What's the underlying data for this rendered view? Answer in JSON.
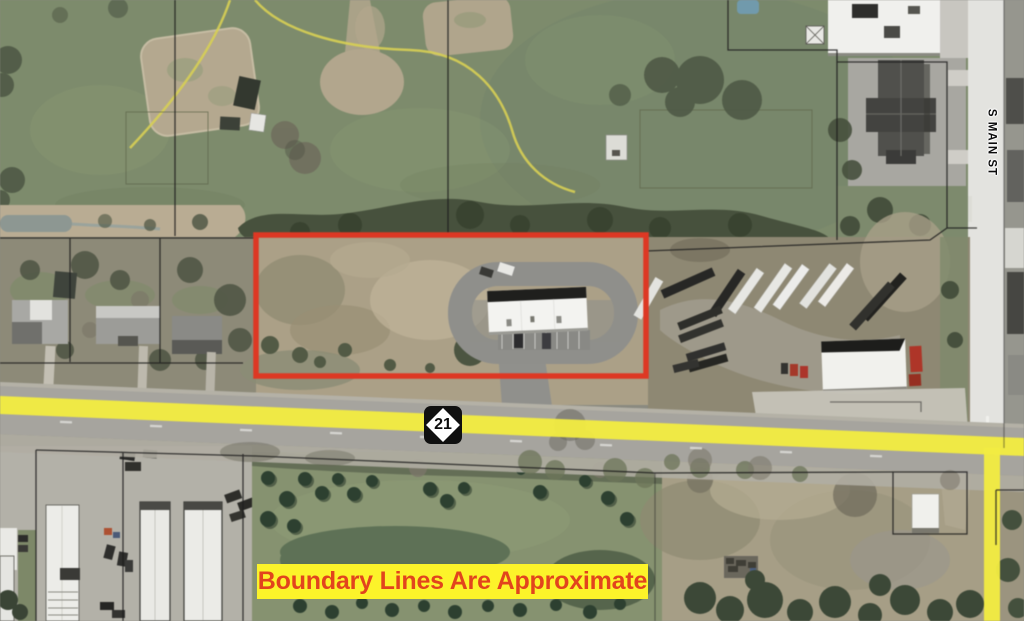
{
  "map": {
    "type": "aerial-parcel-map",
    "street_label": "S MAIN ST",
    "route_shield_number": "21",
    "disclaimer_banner": "Boundary Lines Are Approximate"
  },
  "colors": {
    "boundary_red": "#e23722",
    "highlight_yellow": "#f3eb3b",
    "banner_bg": "#fcf32a",
    "banner_text": "#e2441d",
    "shield_bg": "#101010",
    "shield_diamond": "#ffffff",
    "parcel_line": "#1e1e1e"
  }
}
